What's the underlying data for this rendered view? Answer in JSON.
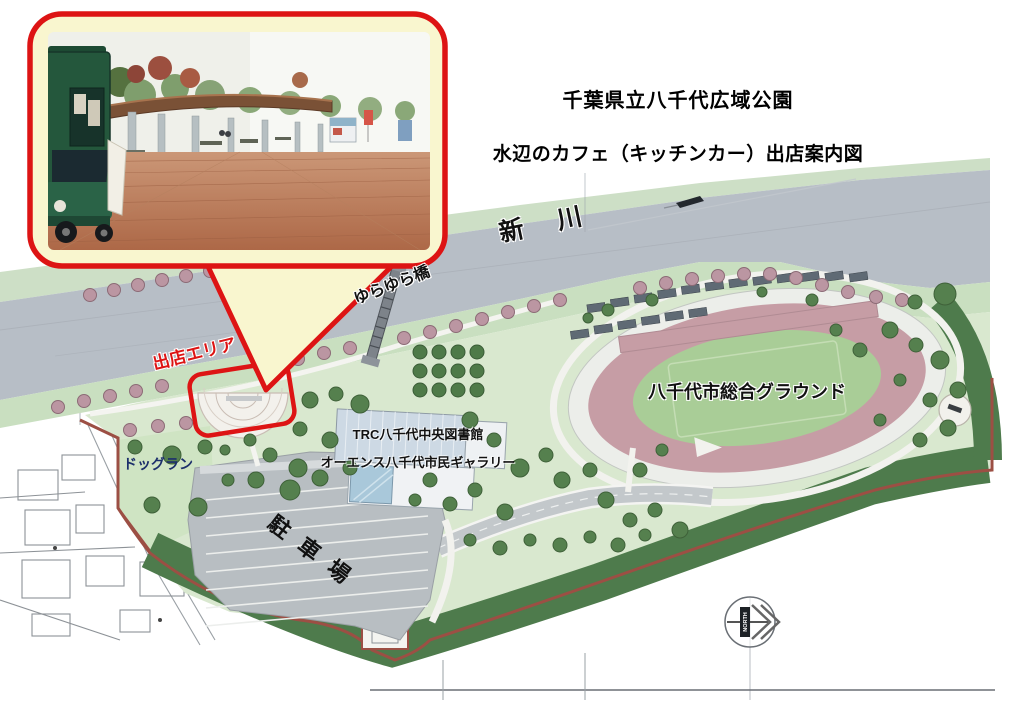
{
  "header": {
    "title": "千葉県立八千代広域公園",
    "subtitle": "水辺のカフェ（キッチンカー）出店案内図"
  },
  "map": {
    "labels": {
      "river": "新川",
      "bridge": "ゆらゆら橋",
      "vendor_area": "出店エリア",
      "library_line1": "TRC八千代中央図書館",
      "library_line2": "オーエンス八千代市民ギャラリー",
      "dog_run": "ドッグラン",
      "parking": "駐車場",
      "ground": "八千代市総合グラウンド",
      "north": "NORTH"
    },
    "colors": {
      "accent_red": "#dd1414",
      "callout_bg": "#f9f6cf",
      "river": "#b7bec6",
      "bank_green": "#c9dfc0",
      "north_bank_green": "#cddfc6",
      "park_green": "#d9e8cf",
      "dogrun_green": "#cfe4c3",
      "forest_green": "#4e7b4c",
      "track_pink": "#c69da5",
      "infield_green": "#a9cd97",
      "boundary_brown": "#9c4f44",
      "parking_gray": "#b8bec2",
      "dogrun_label_navy": "#1c2f6b",
      "tree_mauve": "#bb96a2",
      "tree_green": "#55804e"
    },
    "icons": {
      "north_arrow": "north-arrow-icon",
      "boat": "boat-icon"
    }
  }
}
